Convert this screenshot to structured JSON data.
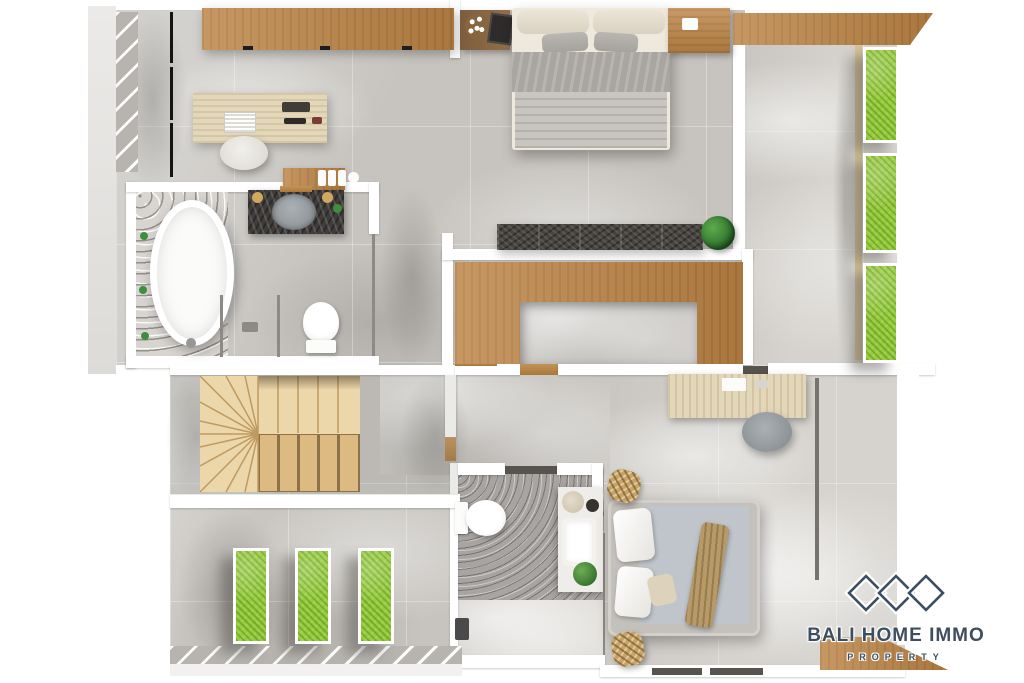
{
  "watermark": {
    "brand": "BALI HOME IMMO",
    "tagline": "PROPERTY",
    "icon": "three-diamonds"
  },
  "palette": {
    "floor_light": "#d6d3ce",
    "floor_mid": "#c7c4bf",
    "floor_dark": "#aeaba7",
    "wall_white": "#ffffff",
    "wood": "#bc8445",
    "desk_wood_pale": "#e3d7ba",
    "stair_wood": "#dcba82",
    "stair_wood_light": "#ecd7aa",
    "planter_green": "#99ca40",
    "plant_green": "#3e8f3b",
    "bench_dark": "#47433f",
    "terrazzo": "#d8d4d0",
    "fixture_white": "#fcfcfb",
    "bed_gray": "#a9a5a0",
    "duvet_gray": "#c9c5c0",
    "mattress_blue_gray": "#bfc5cb",
    "throw_tan": "#b79a68",
    "wicker": "#c5a369",
    "navy": "#3c4e60"
  },
  "plan": {
    "view": "top-down-3d-render",
    "rooms": [
      {
        "name": "studio-office",
        "furniture": [
          "wardrobe",
          "work-desk",
          "desk-chair",
          "side-table"
        ]
      },
      {
        "name": "master-bedroom",
        "furniture": [
          "double-bed",
          "nightstand-left",
          "nightstand-right"
        ]
      },
      {
        "name": "master-bathroom",
        "furniture": [
          "freestanding-bathtub",
          "vanity-sink",
          "toilet",
          "walk-in-shower"
        ]
      },
      {
        "name": "kitchen-void",
        "furniture": [
          "stone-console",
          "potted-plant",
          "u-shaped-counter"
        ]
      },
      {
        "name": "right-terrace",
        "furniture": [
          "planter-box",
          "planter-box",
          "planter-box"
        ]
      },
      {
        "name": "staircase",
        "furniture": [
          "wooden-winder-stairs"
        ]
      },
      {
        "name": "front-terrace",
        "furniture": [
          "planter-box",
          "planter-box",
          "planter-box"
        ]
      },
      {
        "name": "guest-bathroom",
        "furniture": [
          "toilet",
          "vanity-sink",
          "potted-plant"
        ]
      },
      {
        "name": "guest-bedroom",
        "furniture": [
          "double-bed",
          "study-desk",
          "desk-chair",
          "rattan-pouf",
          "rattan-pouf"
        ]
      }
    ]
  }
}
